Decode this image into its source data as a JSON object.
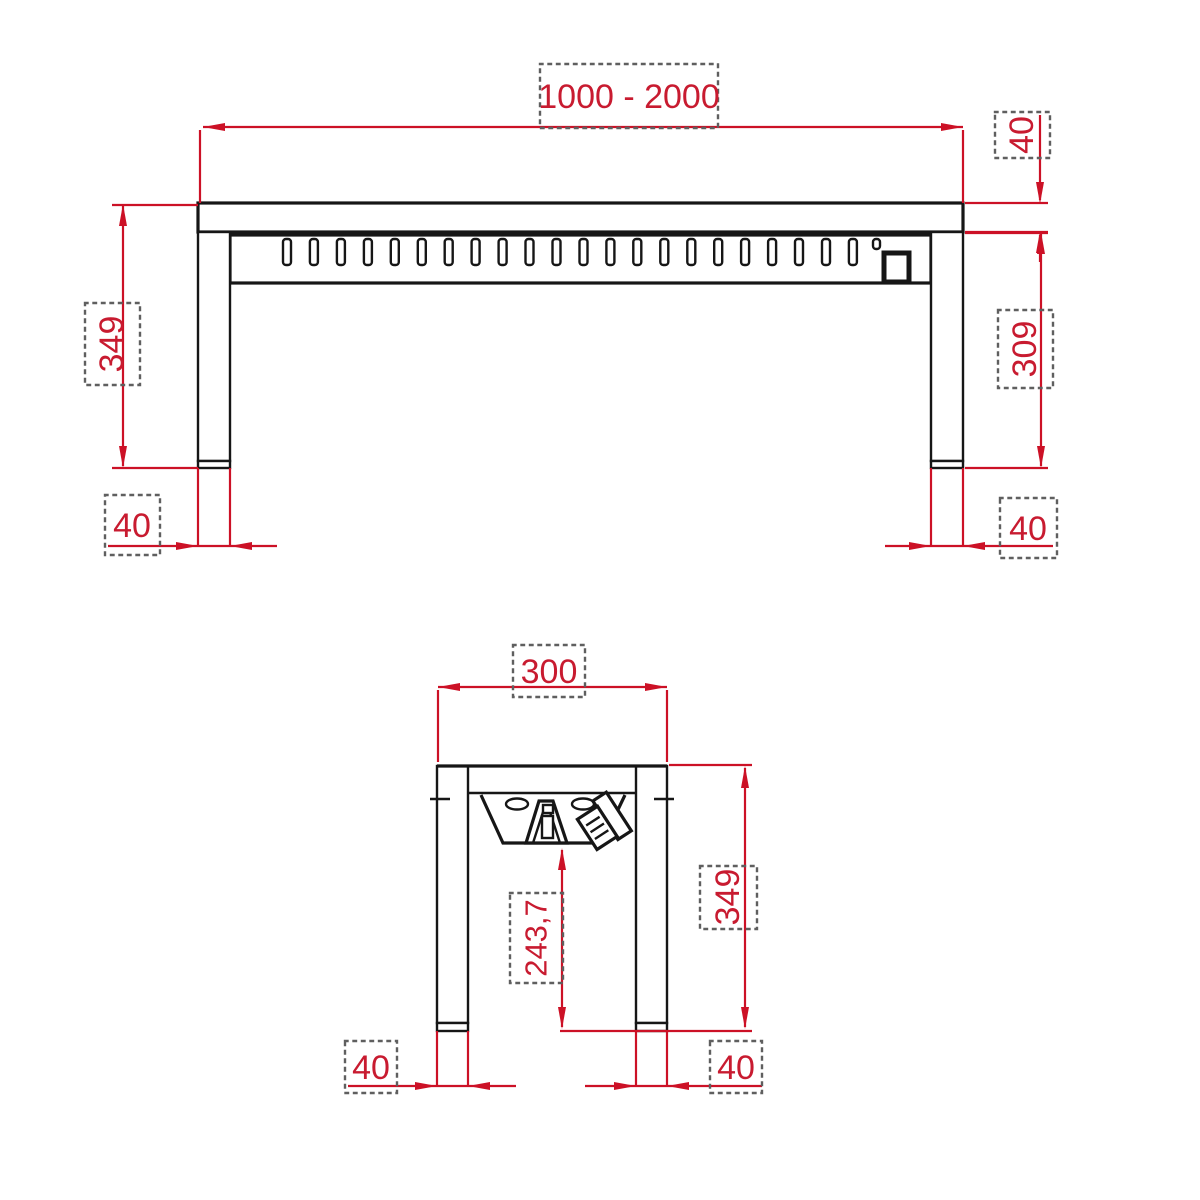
{
  "colors": {
    "dimension_red": "#cc1126",
    "text_red": "#c81b30",
    "line_black": "#161616",
    "dash_gray": "#5f5f5f",
    "background": "#ffffff"
  },
  "front_view": {
    "vent_slot_count": 22,
    "dims": {
      "width_range": "1000 - 2000",
      "top_height": "40",
      "total_height": "349",
      "clearance_height": "309",
      "left_leg_width": "40",
      "right_leg_width": "40"
    }
  },
  "side_view": {
    "dims": {
      "depth": "300",
      "total_height": "349",
      "heater_clearance": "243,7",
      "left_leg_width": "40",
      "right_leg_width": "40"
    }
  }
}
